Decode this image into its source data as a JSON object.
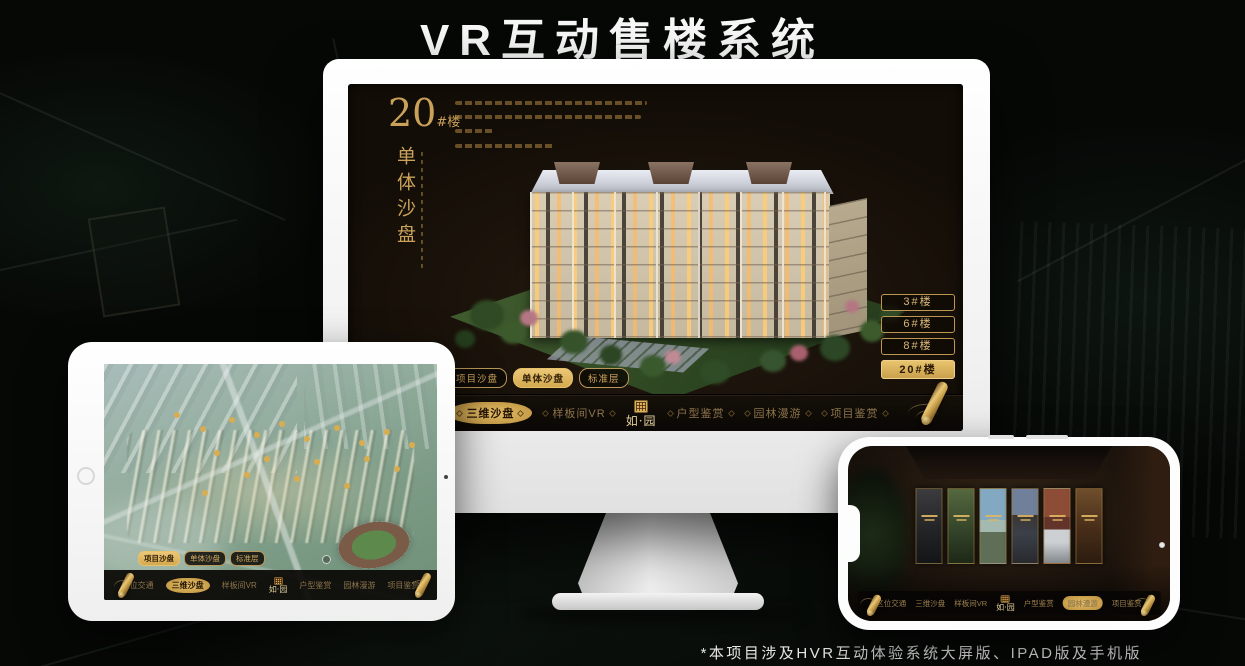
{
  "header": {
    "title": "VR互动售楼系统"
  },
  "footer": {
    "note": "*本项目涉及HVR互动体验系统大屏版、IPAD版及手机版"
  },
  "logo": {
    "name": "如园",
    "text": "如·园"
  },
  "colors": {
    "gold": "#C9A159",
    "gold_bright": "#E7C26C",
    "screen_bg": "#1D150C",
    "nav_text_dim": "#8D744A",
    "title_white": "#F8F8F8"
  },
  "monitor": {
    "title_number": "20",
    "title_suffix": "#楼",
    "subtitle_vertical": "单体沙盘",
    "floor_buttons": [
      {
        "label": "3#楼",
        "active": false
      },
      {
        "label": "6#楼",
        "active": false
      },
      {
        "label": "8#楼",
        "active": false
      },
      {
        "label": "20#楼",
        "active": true
      }
    ],
    "tabs": [
      {
        "label": "项目沙盘",
        "active": false
      },
      {
        "label": "单体沙盘",
        "active": true
      },
      {
        "label": "标准层",
        "active": false
      }
    ],
    "nav": [
      {
        "label": "区位交通",
        "active": false
      },
      {
        "label": "三维沙盘",
        "active": true
      },
      {
        "label": "样板间VR",
        "active": false
      },
      {
        "label": "户型鉴赏",
        "active": false
      },
      {
        "label": "园林漫游",
        "active": false
      },
      {
        "label": "项目鉴赏",
        "active": false
      }
    ]
  },
  "tablet": {
    "tabs": [
      {
        "label": "项目沙盘",
        "active": true
      },
      {
        "label": "单体沙盘",
        "active": false
      },
      {
        "label": "标准层",
        "active": false
      }
    ],
    "nav": [
      {
        "label": "区位交通",
        "active": false
      },
      {
        "label": "三维沙盘",
        "active": true
      },
      {
        "label": "样板间VR",
        "active": false
      },
      {
        "label": "户型鉴赏",
        "active": false
      },
      {
        "label": "园林漫游",
        "active": false
      },
      {
        "label": "项目鉴赏",
        "active": false
      }
    ]
  },
  "phone": {
    "nav": [
      {
        "label": "区位交通",
        "active": false
      },
      {
        "label": "三维沙盘",
        "active": false
      },
      {
        "label": "样板间VR",
        "active": false
      },
      {
        "label": "户型鉴赏",
        "active": false
      },
      {
        "label": "园林漫游",
        "active": true
      },
      {
        "label": "项目鉴赏",
        "active": false
      }
    ]
  }
}
